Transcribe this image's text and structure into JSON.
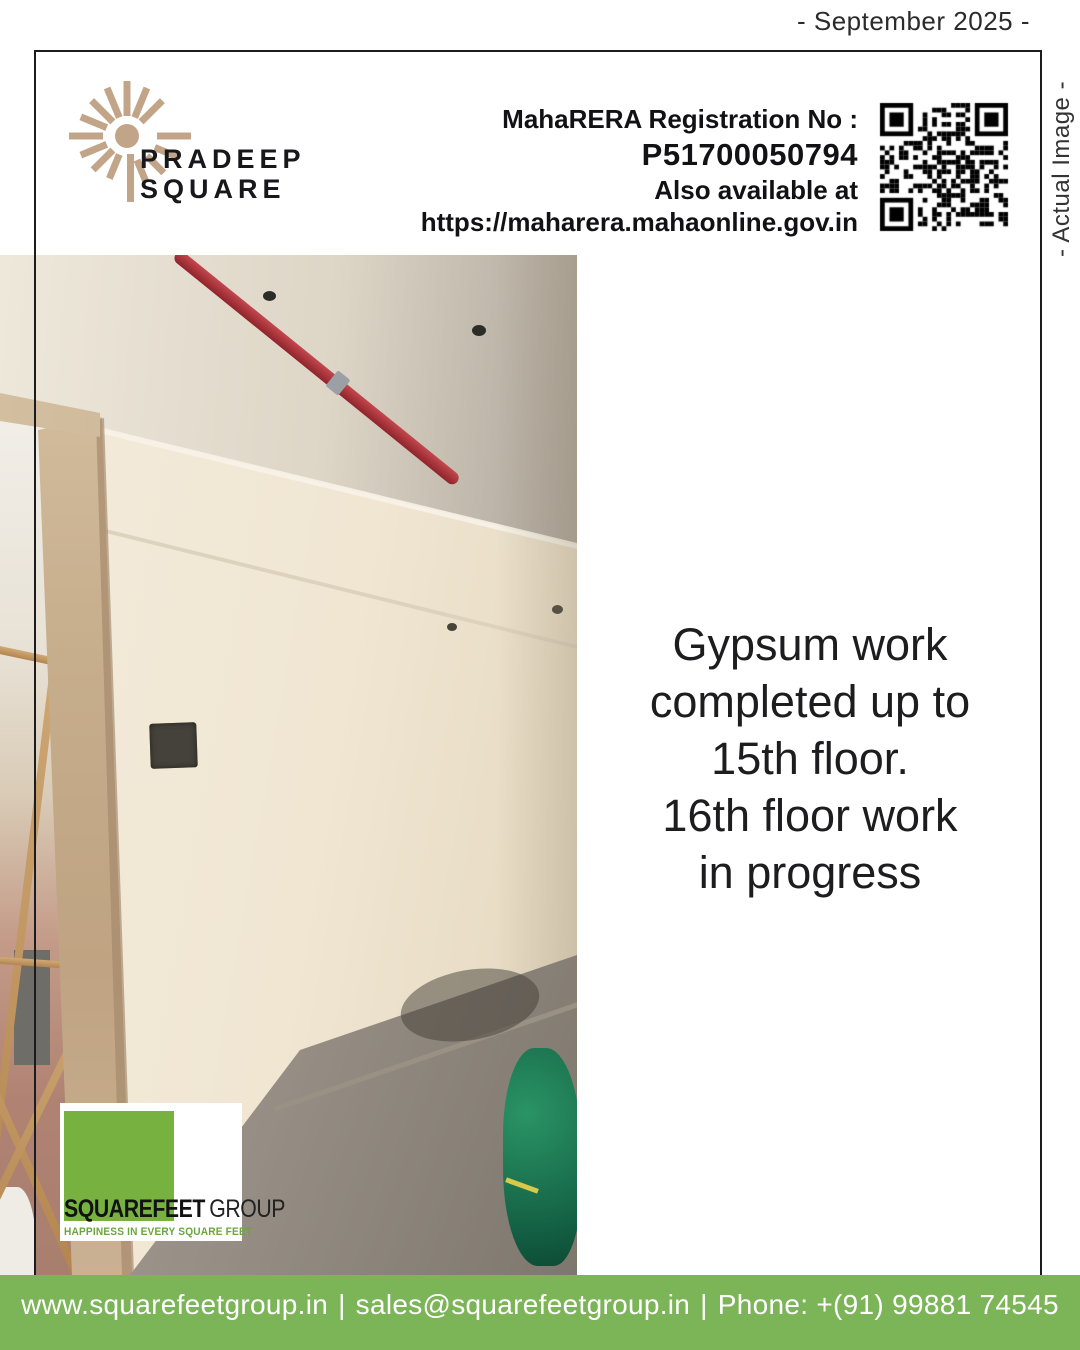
{
  "meta": {
    "date_label": "- September 2025 -",
    "actual_image_label": "- Actual Image -"
  },
  "brand": {
    "name": "PRADEEP\nSQUARE"
  },
  "rera": {
    "label": "MahaRERA Registration No :",
    "number": "P51700050794",
    "also_line": "Also available at",
    "url": "https://maharera.mahaonline.gov.in"
  },
  "headline": {
    "text": "Gypsum work\ncompleted up to\n15th floor.\n16th floor work\nin progress"
  },
  "footer_logo": {
    "name_bold": "SQUAREFEET",
    "name_regular": "GROUP",
    "tagline": "HAPPINESS IN EVERY SQUARE FEET"
  },
  "footer_bar": {
    "website": "www.squarefeetgroup.in",
    "email": "sales@squarefeetgroup.in",
    "phone": "Phone: +(91) 99881 74545",
    "separator": "|"
  },
  "colors": {
    "accent_green_bar": "#7cb458",
    "logo_green_square": "#77b241",
    "tagline_green": "#6aa63c",
    "brand_tan": "#c2a588",
    "pipe_red": "#a83038",
    "text_dark": "#1d1d1f"
  }
}
